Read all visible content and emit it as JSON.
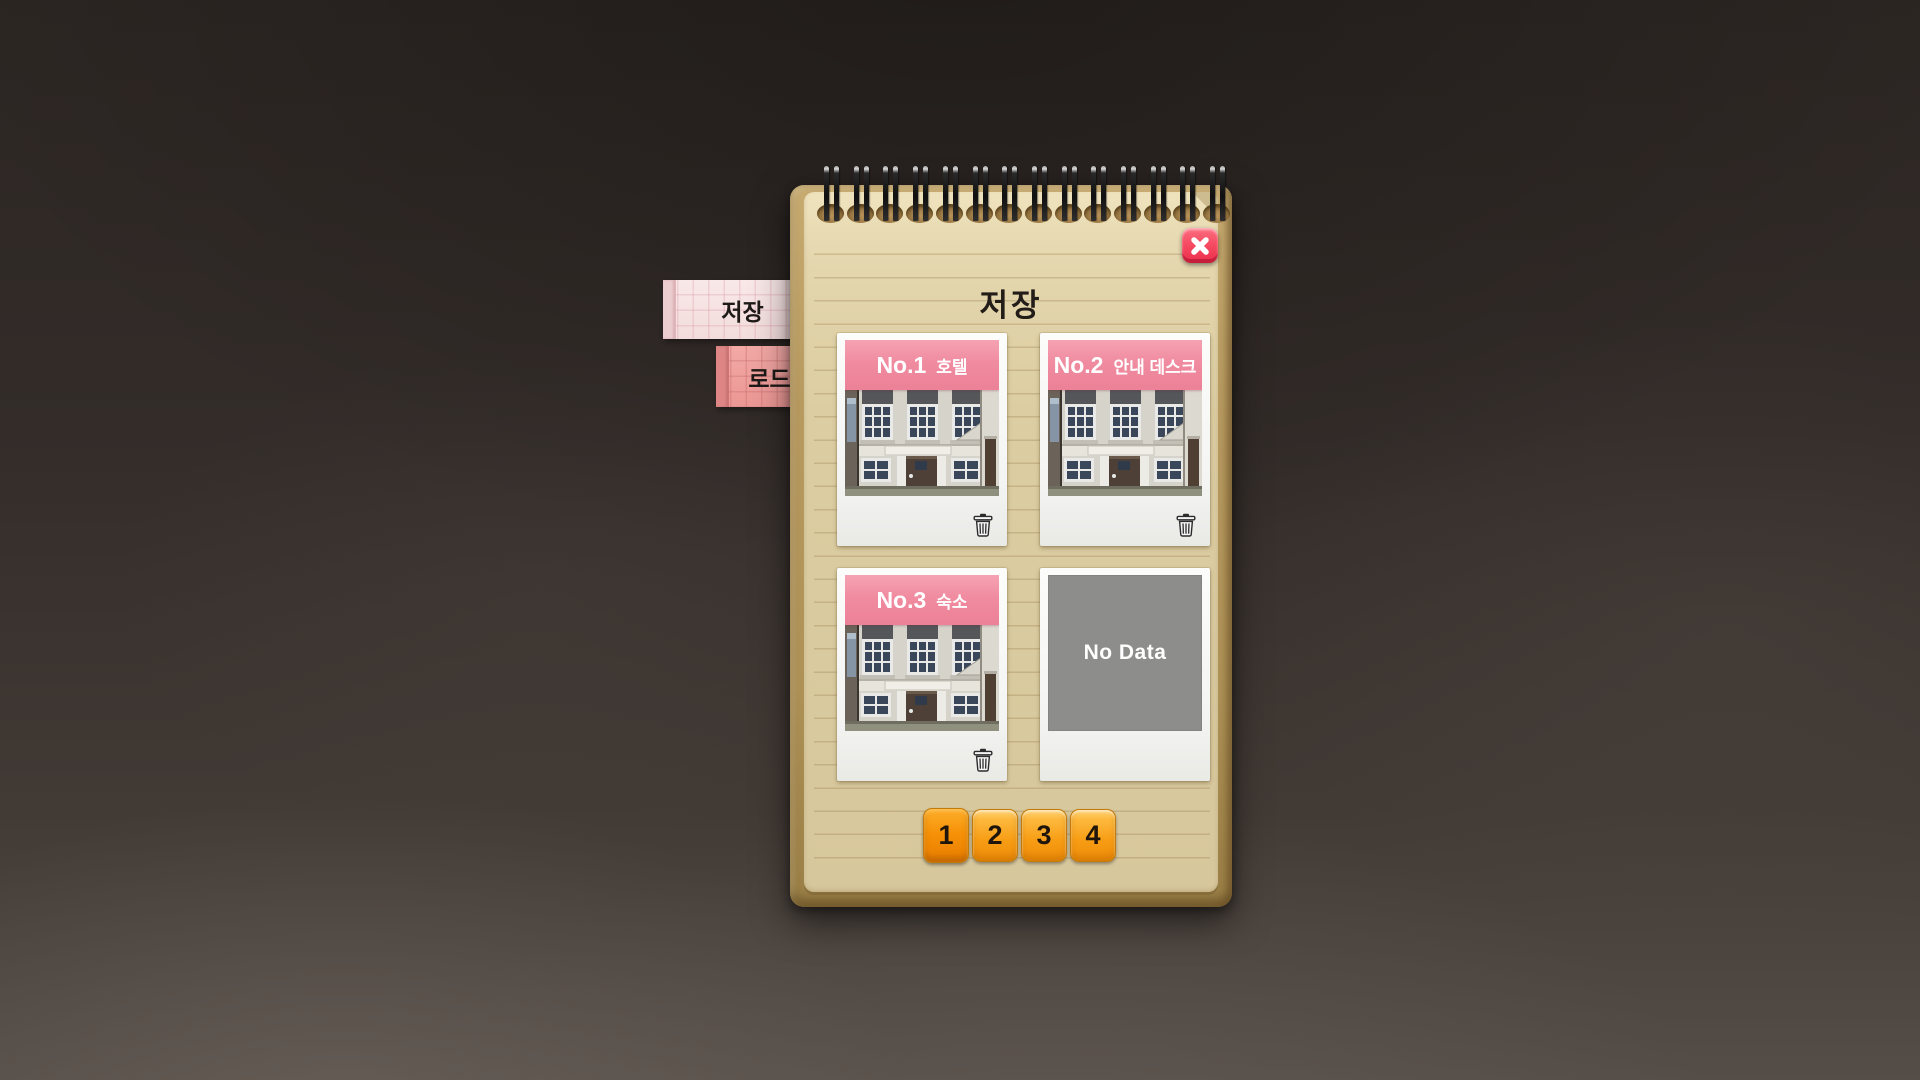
{
  "panel": {
    "title": "저장"
  },
  "tabs": {
    "save": {
      "label": "저장",
      "active": true
    },
    "load": {
      "label": "로드",
      "active": false
    }
  },
  "slots": [
    {
      "id": "No.1",
      "name": "호텔",
      "has_data": true
    },
    {
      "id": "No.2",
      "name": "안내 데스크",
      "has_data": true
    },
    {
      "id": "No.3",
      "name": "숙소",
      "has_data": true
    },
    {
      "empty_label": "No Data",
      "has_data": false
    }
  ],
  "pagination": {
    "pages": [
      "1",
      "2",
      "3",
      "4"
    ],
    "current": "1"
  },
  "icons": {
    "close": "x-icon",
    "delete": "trash-icon"
  },
  "colors": {
    "paper": "#d9caa2",
    "cover": "#b2965e",
    "slot_header_pink": "#ee8599",
    "tab_save_pink": "#f6e2e2",
    "tab_load_pink": "#ee9f9c",
    "page_button_orange": "#f6a41c",
    "page_button_active": "#ef8b00",
    "close_red": "#f2495f",
    "no_data_gray": "#8d8d8b",
    "background": "#332c29"
  }
}
